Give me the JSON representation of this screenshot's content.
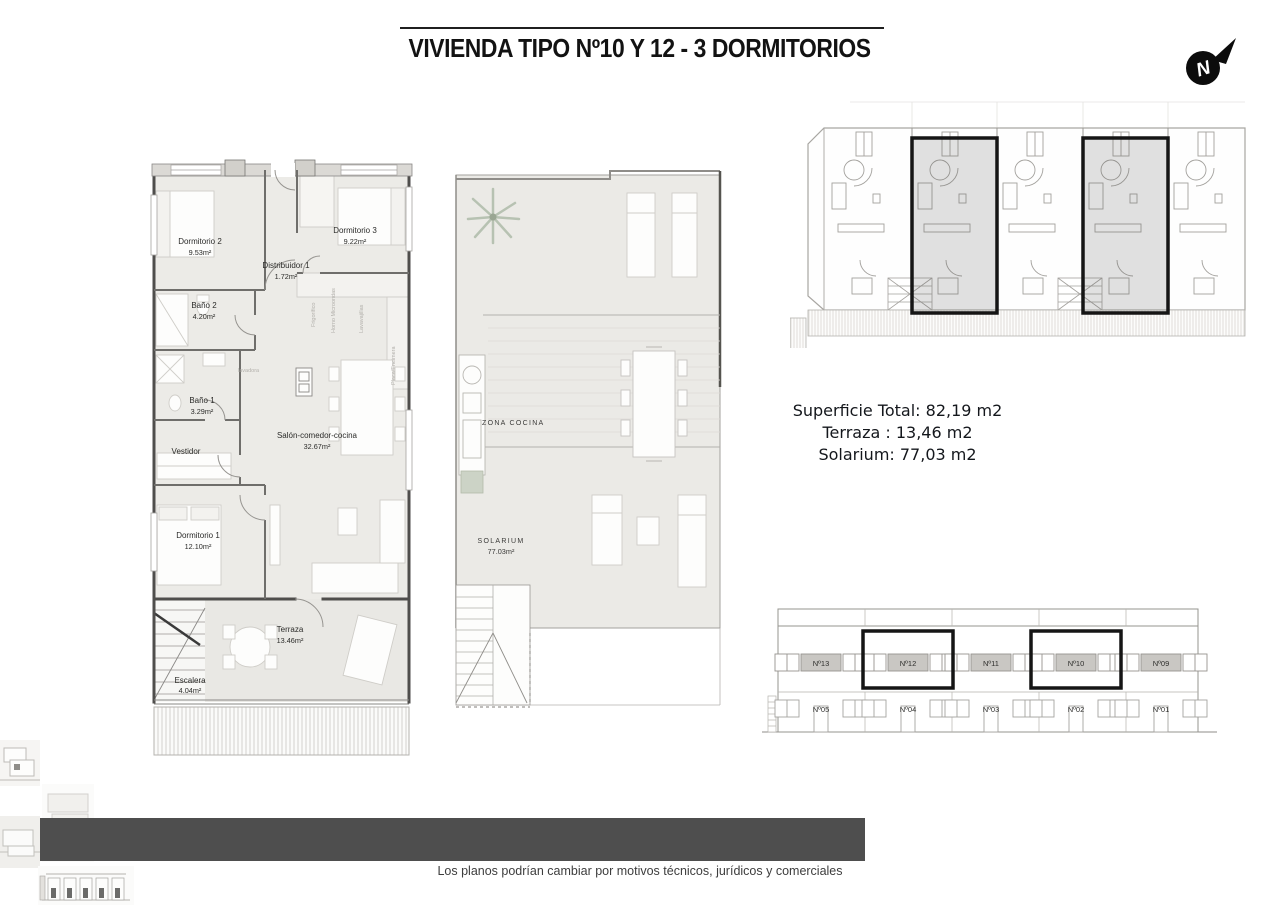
{
  "title": "VIVIENDA TIPO Nº10 Y 12 - 3 DORMITORIOS",
  "compass": {
    "label": "N"
  },
  "floor_plan": {
    "rooms": [
      {
        "name": "Dormitorio 2",
        "area": "9.53m²"
      },
      {
        "name": "Dormitorio 3",
        "area": "9.22m²"
      },
      {
        "name": "Distribuidor 1",
        "area": "1.72m²"
      },
      {
        "name": "Baño 2",
        "area": "4.20m²"
      },
      {
        "name": "Baño 1",
        "area": "3.29m²"
      },
      {
        "name": "Vestidor",
        "area": ""
      },
      {
        "name": "Salón-comedor-cocina",
        "area": "32.67m²"
      },
      {
        "name": "Dormitorio 1",
        "area": "12.10m²"
      },
      {
        "name": "Terraza",
        "area": "13.46m²"
      },
      {
        "name": "Escalera",
        "area": "4.04m²"
      }
    ],
    "appliances": [
      "Frigorífico",
      "Horno Microondas",
      "Lavavajillas",
      "Placa/Encimera",
      "lavadora"
    ]
  },
  "solarium_plan": {
    "kitchen_label": "ZONA COCINA",
    "solarium_label": "SOLARIUM",
    "solarium_area": "77.03m²"
  },
  "summary": {
    "line1": "Superficie Total: 82,19 m2",
    "line2": "Terraza : 13,46 m2",
    "line3": "Solarium: 77,03 m2"
  },
  "elevation": {
    "top_units": [
      "Nº13",
      "Nº12",
      "Nº11",
      "Nº10",
      "Nº09"
    ],
    "bottom_units": [
      "Nº05",
      "Nº04",
      "Nº03",
      "Nº02",
      "Nº01"
    ],
    "highlighted_units": [
      "Nº12",
      "Nº10"
    ]
  },
  "disclaimer": "Los planos podrían cambiar por motivos técnicos, jurídicos y comerciales",
  "colors": {
    "wall": "#4f4e4c",
    "floor_fill": "#ecebe7",
    "highlight_outline": "#151515",
    "unit_shade_opacity": "0.18",
    "elevation_label_bg": "#c9c7c3",
    "bar": "#4e4e4e"
  }
}
